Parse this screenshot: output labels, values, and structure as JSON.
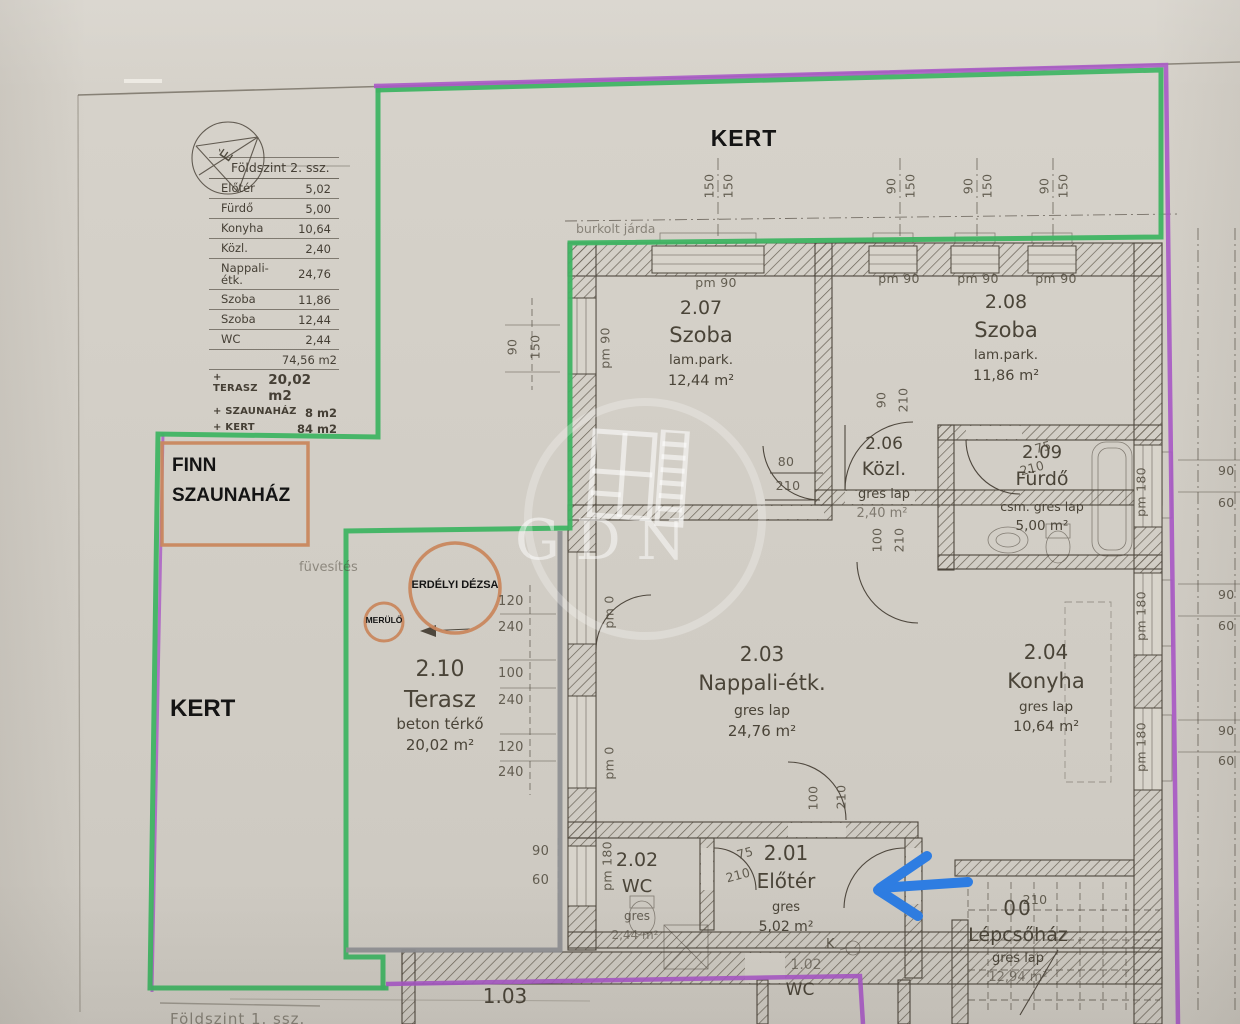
{
  "compass": {
    "letter": "É"
  },
  "area_table": {
    "title": "Földszint 2. ssz.",
    "rows": [
      {
        "label": "Előtér",
        "value": "5,02"
      },
      {
        "label": "Fürdő",
        "value": "5,00"
      },
      {
        "label": "Konyha",
        "value": "10,64"
      },
      {
        "label": "Közl.",
        "value": "2,40"
      },
      {
        "label": "Nappali-étk.",
        "value": "24,76"
      },
      {
        "label": "Szoba",
        "value": "11,86"
      },
      {
        "label": "Szoba",
        "value": "12,44"
      },
      {
        "label": "WC",
        "value": "2,44"
      }
    ],
    "total": "74,56 m2",
    "extras": [
      {
        "label": "+ TERASZ",
        "value": "20,02 m2"
      },
      {
        "label": "+ SZAUNAHÁZ",
        "value": "8 m2"
      },
      {
        "label": "+ KERT",
        "value": "84 m2"
      }
    ]
  },
  "site": {
    "kert_top": "KERT",
    "kert_left": "KERT",
    "sauna_line1": "FINN",
    "sauna_line2": "SZAUNAHÁZ",
    "fuvesites": "füvesítés",
    "jarda": "burkolt járda",
    "dezsa": "ERDÉLYI DÉZSA",
    "merulo": "MERÜLŐ"
  },
  "rooms": [
    {
      "number": "2.07",
      "name": "Szoba",
      "finish": "lam.park.",
      "area": "12,44 m²"
    },
    {
      "number": "2.08",
      "name": "Szoba",
      "finish": "lam.park.",
      "area": "11,86 m²"
    },
    {
      "number": "2.06",
      "name": "Közl.",
      "finish": "gres lap",
      "area": "2,40 m²"
    },
    {
      "number": "2.09",
      "name": "Fürdő",
      "finish": "csm. gres lap",
      "area": "5,00 m²"
    },
    {
      "number": "2.03",
      "name": "Nappali-étk.",
      "finish": "gres lap",
      "area": "24,76 m²"
    },
    {
      "number": "2.04",
      "name": "Konyha",
      "finish": "gres lap",
      "area": "10,64 m²"
    },
    {
      "number": "2.10",
      "name": "Terasz",
      "finish": "beton térkő",
      "area": "20,02 m²"
    },
    {
      "number": "2.02",
      "name": "WC",
      "finish": "gres",
      "area": "2,44 m²"
    },
    {
      "number": "2.01",
      "name": "Előtér",
      "finish": "gres",
      "area": "5,02 m²"
    },
    {
      "number": "00",
      "name": "Lépcsőház",
      "finish": "gres lap",
      "area": "12,94 m²"
    },
    {
      "number": "1.03"
    },
    {
      "number": "1.02",
      "name": "WC"
    }
  ],
  "dims": {
    "pm90": "pm 90",
    "pm0": "pm 0",
    "pm180": "pm 180",
    "top_pairs": [
      [
        "150",
        "150"
      ],
      [
        "90",
        "150"
      ],
      [
        "90",
        "150"
      ],
      [
        "90",
        "150"
      ]
    ],
    "left_pair": [
      "90",
      "150"
    ],
    "terasz_chain": [
      "120",
      "240",
      "100",
      "240",
      "120",
      "240"
    ],
    "terasz_bottom": [
      "90",
      "60"
    ],
    "right_pairs": [
      [
        "90",
        "60"
      ],
      [
        "90",
        "60"
      ],
      [
        "90",
        "60"
      ]
    ],
    "door_szoba1": [
      "80",
      "210"
    ],
    "door_szoba2": [
      "90",
      "210"
    ],
    "door_furdo": [
      "75",
      "210"
    ],
    "door_kozl": [
      "100",
      "210"
    ],
    "door_nappali": [
      "100",
      "210"
    ],
    "door_wc": [
      "75",
      "210"
    ],
    "door_entry": "210",
    "k_symbol": "K"
  },
  "watermark": {
    "text": "GDN"
  },
  "footer": {
    "floor1": "Földszint 1. ssz."
  },
  "annotation_colors": {
    "green": "#3fb463",
    "purple": "#a958c6",
    "grey": "#8f9094",
    "orange": "#c9875e",
    "blue": "#2e7de2"
  }
}
